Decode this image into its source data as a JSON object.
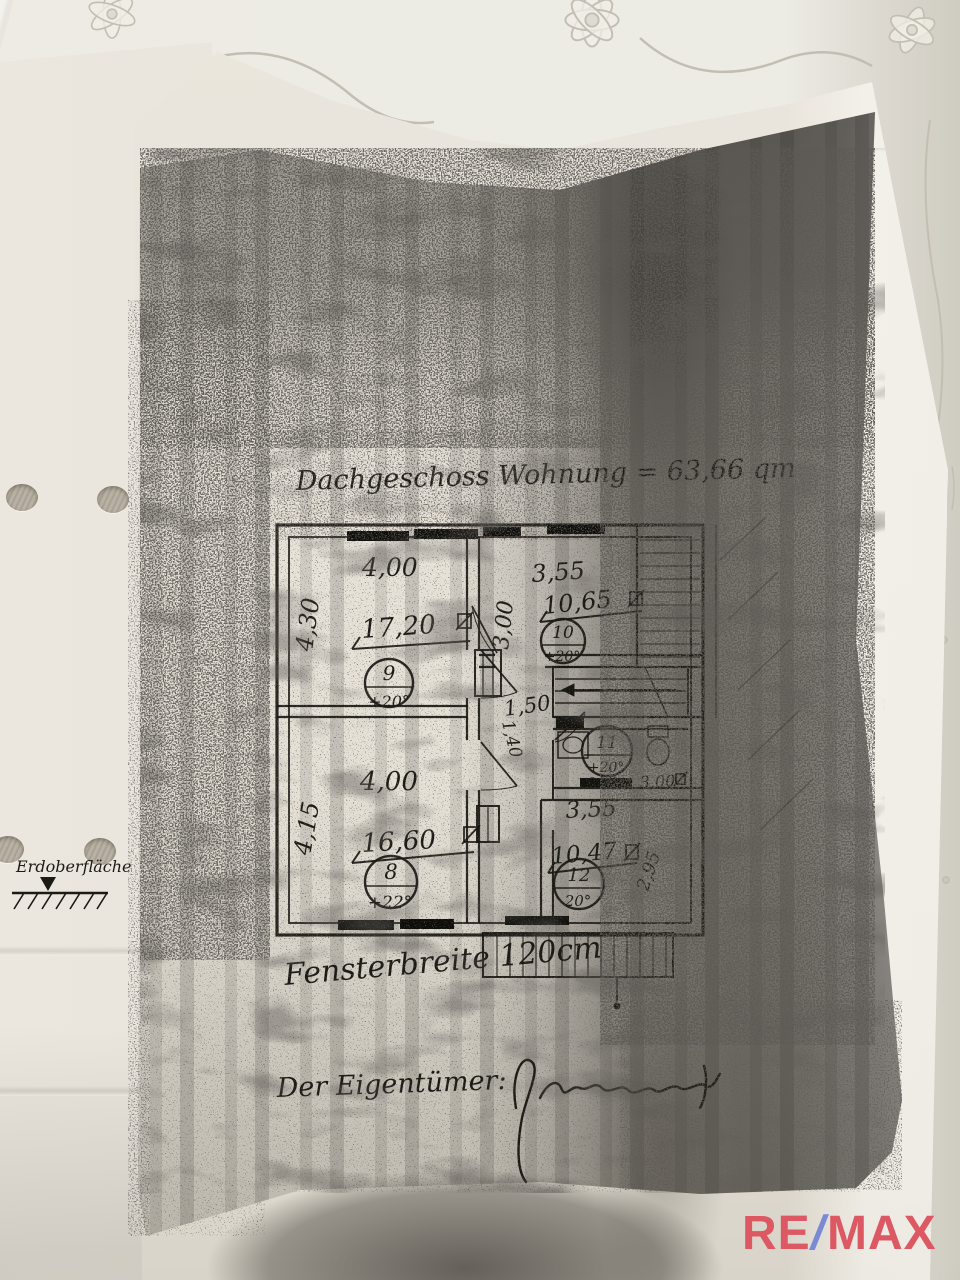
{
  "document": {
    "title": "Dachgeschoss Wohnung = 63,66 qm",
    "window_note": "Fensterbreite 120cm",
    "owner_label": "Der Eigentümer:",
    "ground_label": "Erdoberfläche"
  },
  "floor_plan": {
    "rooms": [
      {
        "number": "9",
        "area": "17,20",
        "temperature": "+20°",
        "width": "4,00",
        "depth": "4,30"
      },
      {
        "number": "10",
        "area": "10,65",
        "temperature": "+20°",
        "width": "3,55",
        "depth": "3,00"
      },
      {
        "number": "8",
        "area": "16,60",
        "temperature": "+22°",
        "width": "4,00",
        "depth": "4,15"
      },
      {
        "number": "12",
        "area": "10,47",
        "temperature": "20°",
        "width": "3,55",
        "depth": "2,95"
      },
      {
        "number": "11",
        "area": "3,00",
        "temperature": "+20°",
        "width": "0,70"
      }
    ],
    "hallway": {
      "width": "1,50",
      "depth": "1,40"
    }
  },
  "branding": {
    "re": "RE",
    "slash": "/",
    "max": "MAX"
  },
  "colors": {
    "remax_red": "#dc5863",
    "remax_blue": "#7a8bd4"
  }
}
